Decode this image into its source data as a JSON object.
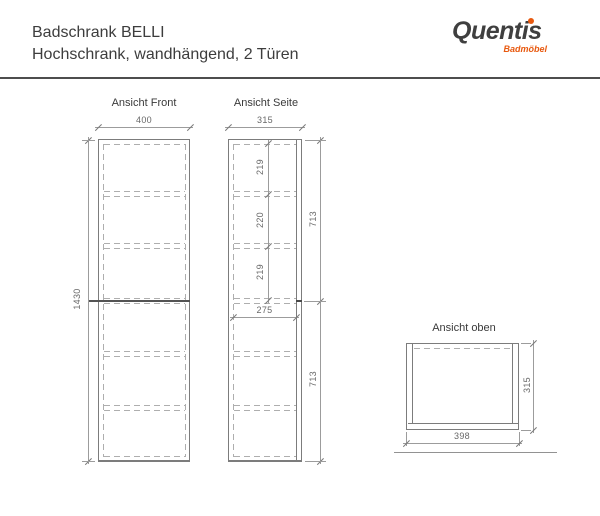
{
  "header": {
    "title_line1": "Badschrank BELLI",
    "title_line2": "Hochschrank, wandhängend, 2 Türen"
  },
  "logo": {
    "brand": "Quentis",
    "subtitle": "Badmöbel",
    "brand_color": "#3f3f3f",
    "accent_color": "#e8590f"
  },
  "front_view": {
    "label": "Ansicht Front",
    "width_mm": "400",
    "height_mm": "1430"
  },
  "side_view": {
    "label": "Ansicht Seite",
    "depth_mm": "315",
    "inner_depth_mm": "275",
    "upper_section_mm": "713",
    "lower_section_mm": "713",
    "shelf_spacing_top_mm": "219",
    "shelf_spacing_middle_mm": "220",
    "shelf_spacing_bottom_mm": "219"
  },
  "top_view": {
    "label": "Ansicht oben",
    "width_mm": "398",
    "depth_mm": "315"
  },
  "drawing_colors": {
    "cabinet_line": "#7c7c7c",
    "dimension_line": "#9c9c9c",
    "hidden_line": "#aeaeae",
    "text": "#686868"
  }
}
